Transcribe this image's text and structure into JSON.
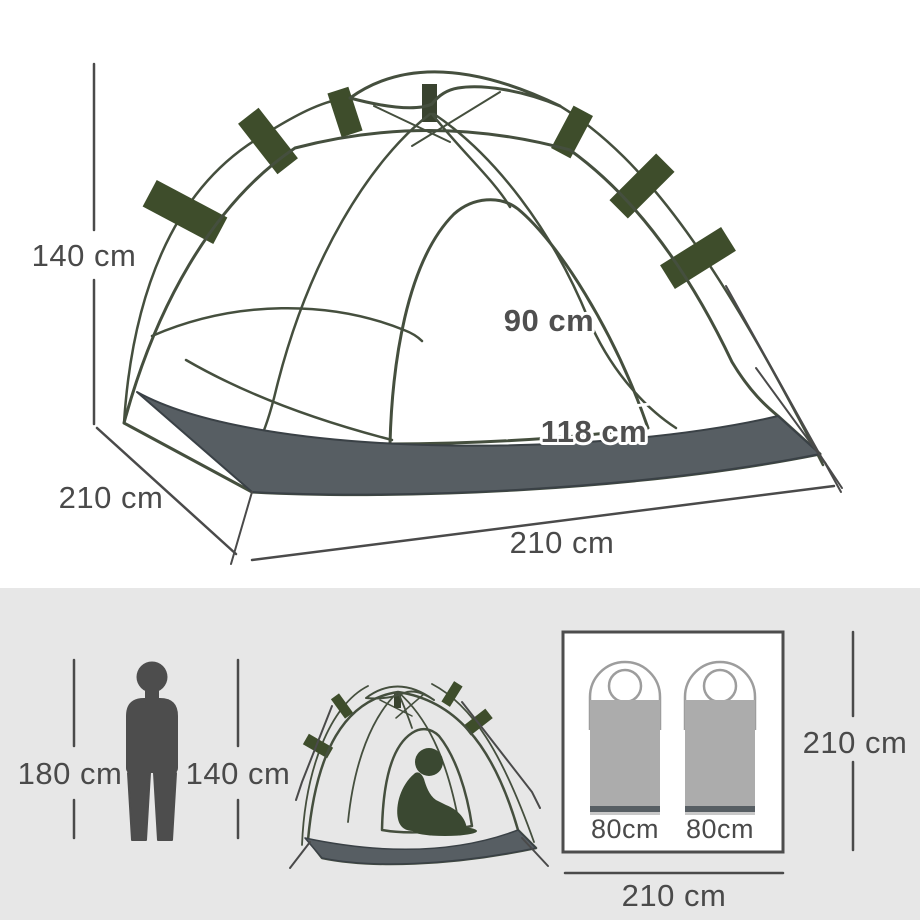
{
  "colors": {
    "panel_background": "#e7e7e7",
    "dimension_lines_text": "#4a4a4a",
    "tent_body_green": "#8ca185",
    "tent_outline_green": "#454f3e",
    "tent_door_light_green": "#b4c8a3",
    "tent_fly_patch_dark_green": "#3e4d2b",
    "groundsheet_gray": "#575e63",
    "figure_gray": "#4d4d4d",
    "seated_figure_dark_green": "#3a4831",
    "sleeping_bag_gray": "#acacac",
    "sleeping_bag_outline": "#9d9d9d",
    "sleeping_bag_stripe": "#575e63"
  },
  "icons": {
    "main_tent": "pop-up-dome-tent-illustration",
    "person": "standing-person-silhouette",
    "small_tent": "dome-tent-with-seated-person",
    "sleeping_bags": "two-sleeping-bags-top-view"
  },
  "main_diagram": {
    "height": "140 cm",
    "depth": "210 cm",
    "width": "210 cm",
    "door_height": "90 cm",
    "door_width": "118 cm"
  },
  "comparison": {
    "person_height": "180 cm",
    "tent_height": "140 cm"
  },
  "floor_plan": {
    "sleeping_bag_1_width": "80cm",
    "sleeping_bag_2_width": "80cm",
    "depth": "210 cm",
    "width": "210 cm"
  }
}
